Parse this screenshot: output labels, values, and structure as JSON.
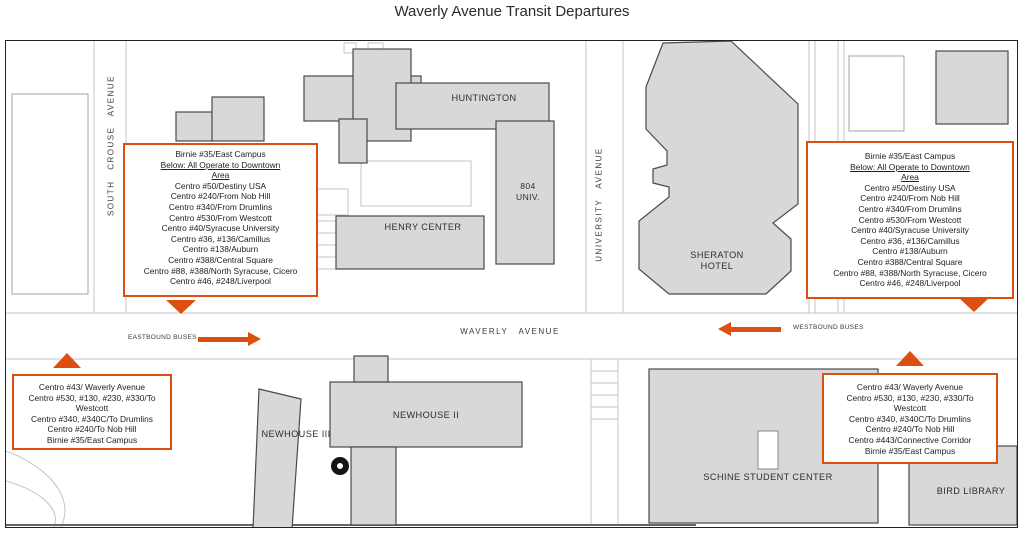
{
  "title": "Waverly Avenue Transit Departures",
  "colors": {
    "accent": "#DC4F10",
    "building_fill": "#D8D8D8",
    "building_stroke": "#4A4A4A",
    "path_line": "#C4C4C4"
  },
  "streets": {
    "south_crouse": "SOUTH CROUSE AVENUE",
    "university": "UNIVERSITY AVENUE",
    "waverly": "WAVERLY AVENUE"
  },
  "flows": {
    "eastbound": "EASTBOUND BUSES",
    "westbound": "WESTBOUND BUSES"
  },
  "buildings": {
    "huntington": "HUNTINGTON",
    "univ804_line1": "804",
    "univ804_line2": "UNIV.",
    "henry_center": "HENRY CENTER",
    "sheraton_line1": "SHERATON",
    "sheraton_line2": "HOTEL",
    "newhouse_ii": "NEWHOUSE II",
    "newhouse_iii": "NEWHOUSE III",
    "schine": "SCHINE STUDENT CENTER",
    "bird_library": "BIRD LIBRARY"
  },
  "info_boxes": {
    "northwest": {
      "lines": [
        "Birnie #35/East Campus",
        "Below: All Operate to Downtown",
        "Area",
        "Centro #50/Destiny USA",
        "Centro #240/From Nob Hill",
        "Centro #340/From Drumlins",
        "Centro #530/From Westcott",
        "Centro #40/Syracuse University",
        "Centro #36, #136/Camillus",
        "Centro #138/Auburn",
        "Centro #388/Central Square",
        "Centro #88, #388/North Syracuse, Cicero",
        "Centro #46, #248/Liverpool"
      ]
    },
    "northeast": {
      "lines": [
        "Birnie #35/East Campus",
        "Below: All Operate to Downtown",
        "Area",
        "Centro #50/Destiny USA",
        "Centro #240/From Nob Hill",
        "Centro #340/From Drumlins",
        "Centro #530/From Westcott",
        "Centro #40/Syracuse University",
        "Centro #36, #136/Camillus",
        "Centro #138/Auburn",
        "Centro #388/Central Square",
        "Centro #88, #388/North Syracuse, Cicero",
        "Centro #46, #248/Liverpool"
      ]
    },
    "southwest": {
      "lines": [
        "Centro #43/ Waverly Avenue",
        "Centro #530, #130, #230, #330/To Westcott",
        "Centro #340, #340C/To Drumlins",
        "Centro #240/To Nob Hill",
        "Birnie #35/East Campus"
      ]
    },
    "southeast": {
      "lines": [
        "Centro #43/ Waverly Avenue",
        "Centro #530, #130, #230, #330/To Westcott",
        "Centro #340, #340C/To Drumlins",
        "Centro #240/To Nob Hill",
        "Centro #443/Connective Corridor",
        "Birnie #35/East Campus"
      ]
    }
  }
}
